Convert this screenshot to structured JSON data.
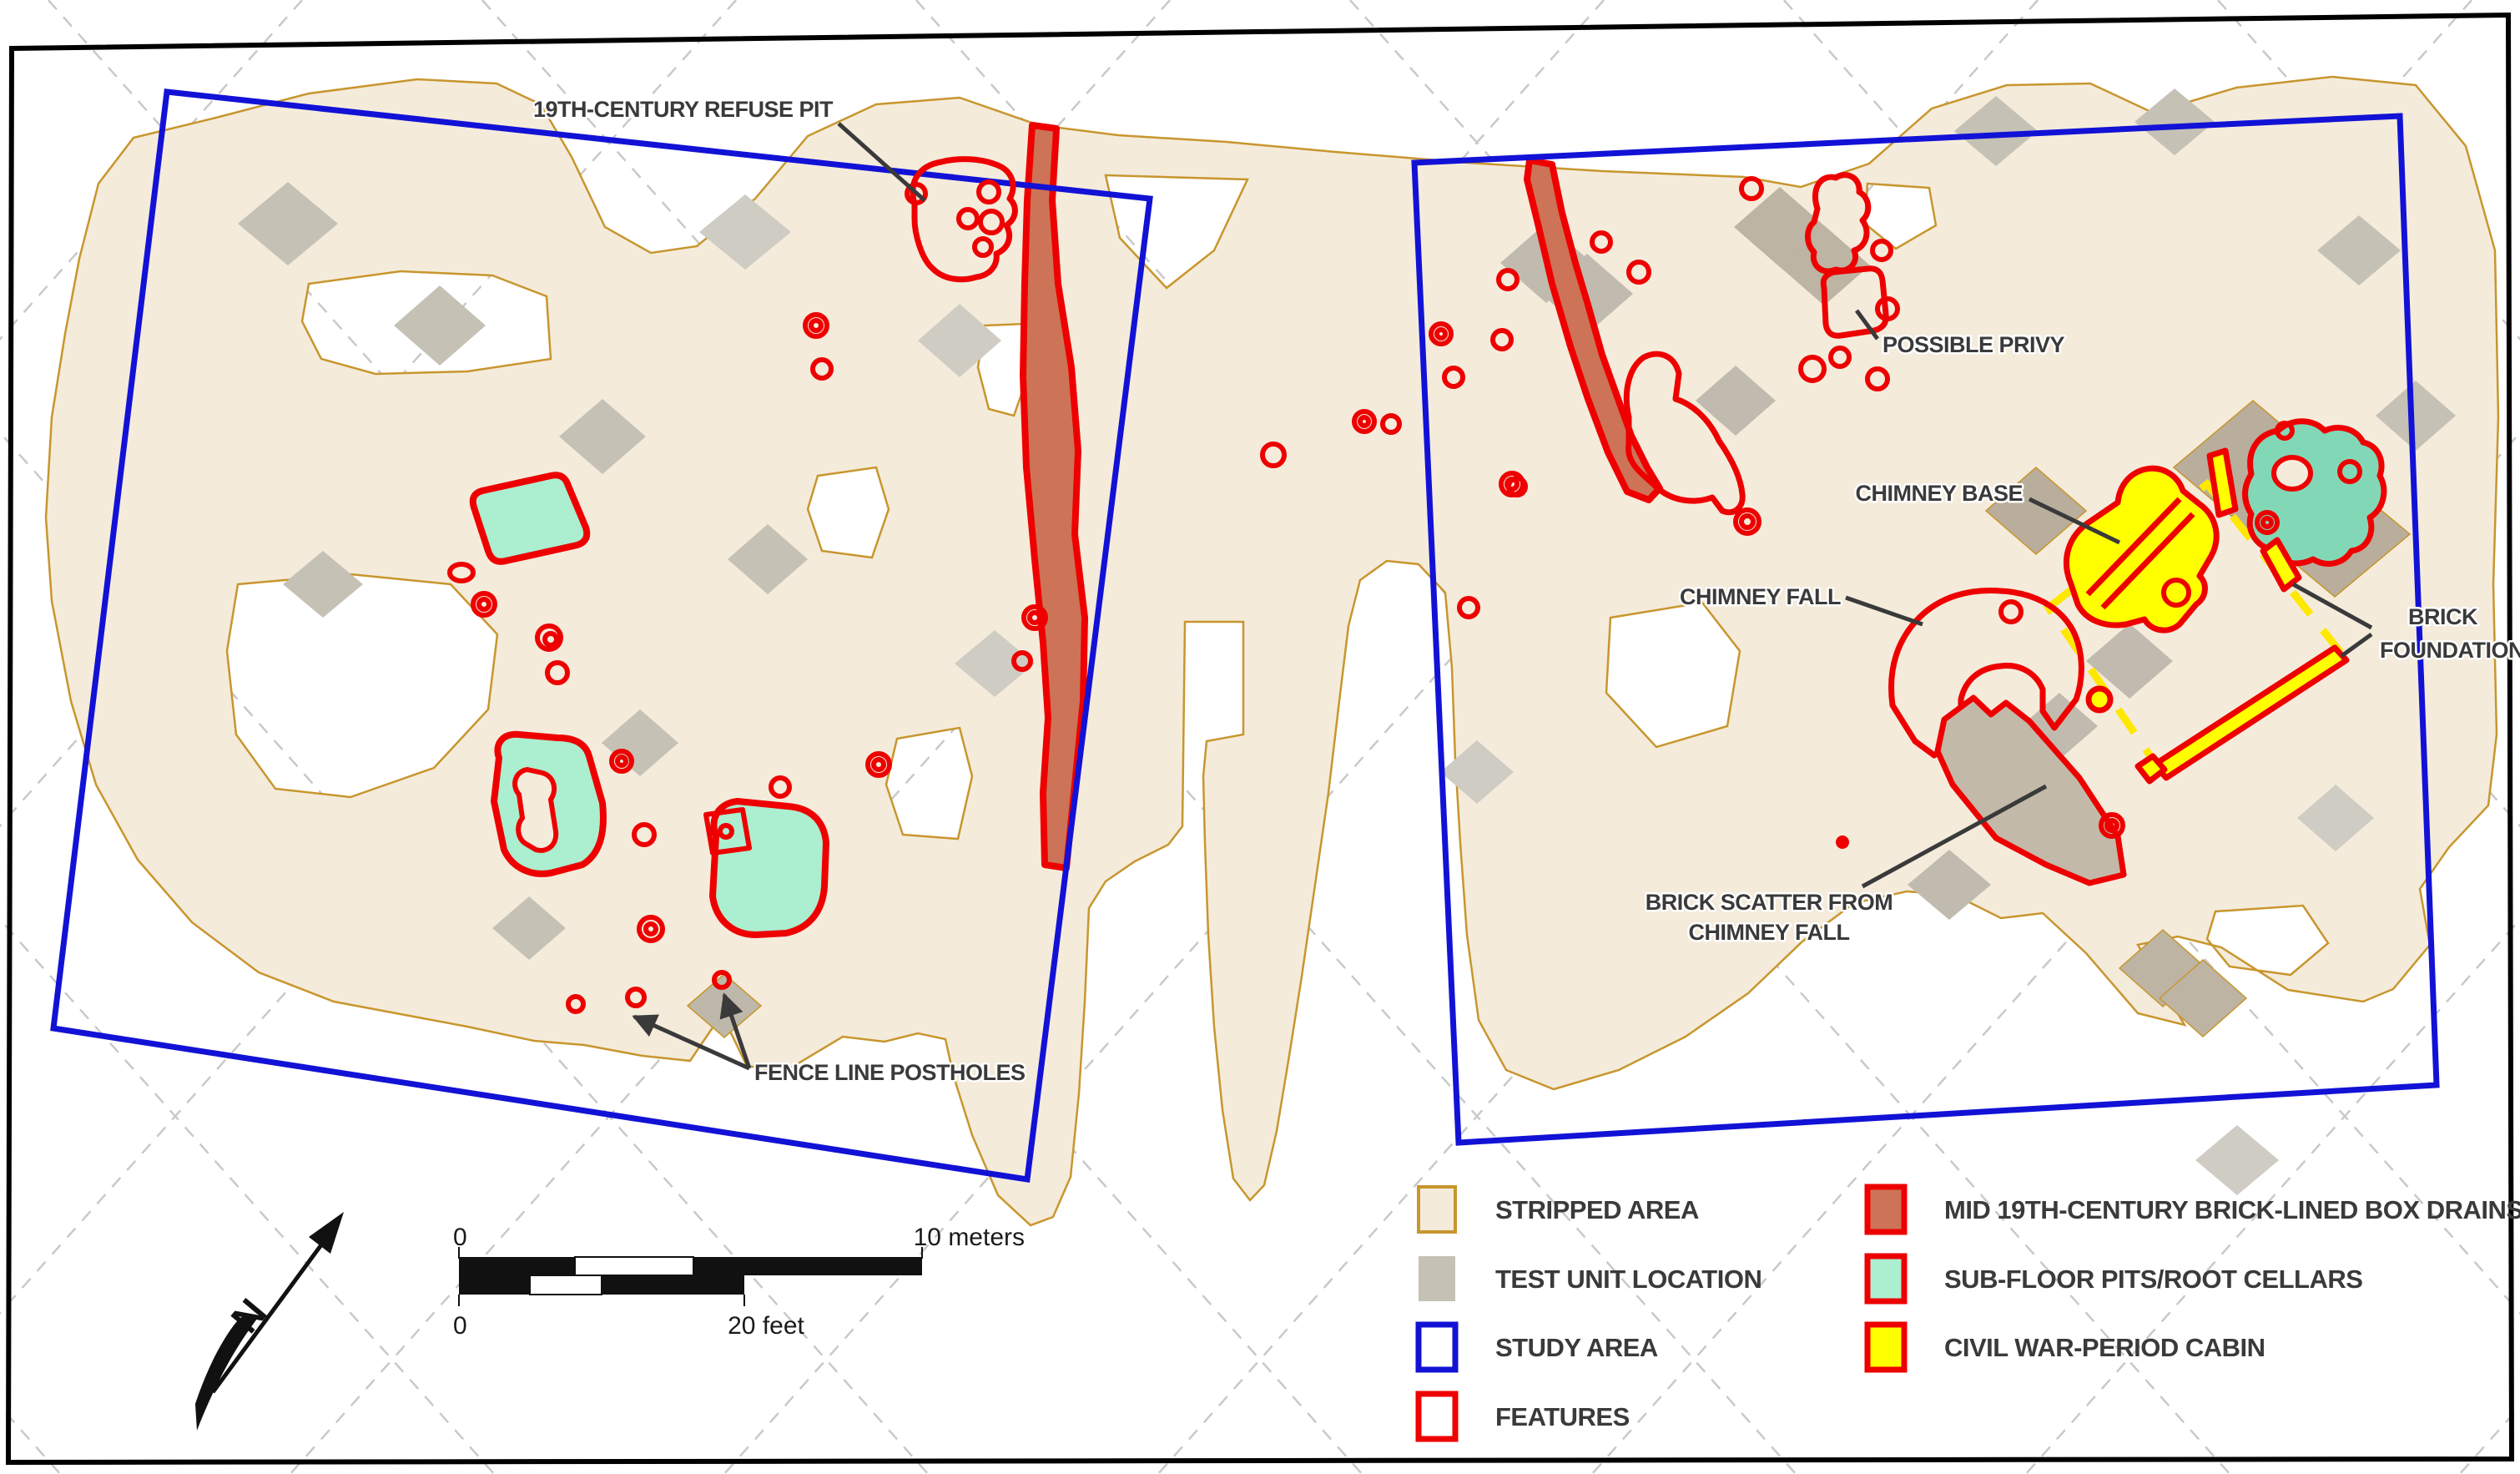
{
  "map": {
    "labels": {
      "refuse_pit": "19TH-CENTURY REFUSE PIT",
      "possible_privy": "POSSIBLE PRIVY",
      "chimney_base": "CHIMNEY BASE",
      "chimney_fall": "CHIMNEY FALL",
      "brick_foundations_line1": "BRICK",
      "brick_foundations_line2": "FOUNDATIONS",
      "brick_scatter_line1": "BRICK SCATTER FROM",
      "brick_scatter_line2": "CHIMNEY FALL",
      "fence_postholes": "FENCE LINE POSTHOLES"
    },
    "north_arrow": {
      "label": "N"
    }
  },
  "legend": {
    "items": [
      {
        "label": "STRIPPED AREA",
        "fill": "#f4ebdb",
        "stroke": "#c8962e"
      },
      {
        "label": "TEST UNIT LOCATION",
        "fill": "#c5c1b5",
        "stroke": "none"
      },
      {
        "label": "STUDY AREA",
        "fill": "#ffffff",
        "stroke": "#1212d6"
      },
      {
        "label": "FEATURES",
        "fill": "#ffffff",
        "stroke": "#ee0000"
      },
      {
        "label": "MID 19TH-CENTURY BRICK-LINED BOX DRAINS",
        "fill": "#cd7357",
        "stroke": "#ee0000"
      },
      {
        "label": "SUB-FLOOR PITS/ROOT CELLARS",
        "fill": "#abeed0",
        "stroke": "#ee0000"
      },
      {
        "label": "CIVIL WAR-PERIOD CABIN",
        "fill": "#ffff00",
        "stroke": "#ee0000"
      }
    ]
  },
  "scale_bar": {
    "meters_zero": "0",
    "meters_max": "10 meters",
    "feet_zero": "0",
    "feet_max": "20 feet"
  },
  "colors": {
    "stripped_area": "#f4ebdb",
    "stripped_border": "#c8962e",
    "test_unit": "#c5c1b5",
    "study_area": "#1212d6",
    "features": "#ee0000",
    "box_drain": "#cd7357",
    "sub_floor_pit": "#abeed0",
    "sub_floor_pit_dark": "#82d8b6",
    "cabin": "#ffff00",
    "label_text": "#3a3a3a",
    "grid_dash": "#c9c9c9"
  }
}
